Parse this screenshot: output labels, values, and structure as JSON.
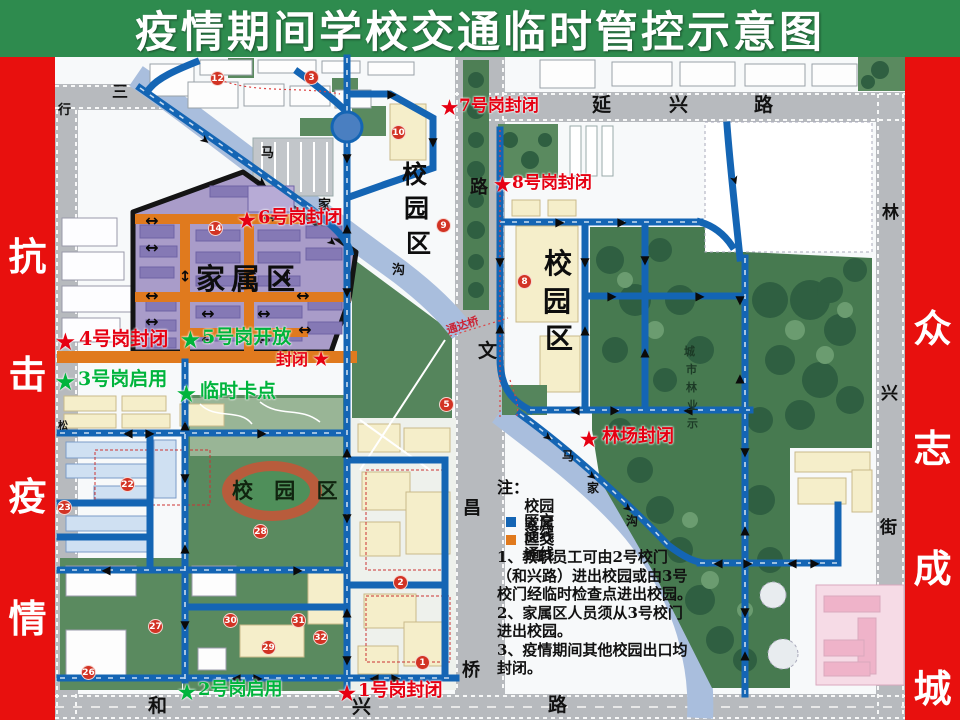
{
  "title": "疫情期间学校交通临时管控示意图",
  "banners": {
    "left": [
      "抗",
      "击",
      "疫",
      "情"
    ],
    "right": [
      "众",
      "志",
      "成",
      "城"
    ]
  },
  "colors": {
    "green_bg": "#2e8b4e",
    "red_banner": "#e8100e",
    "map_bg": "#f7f9fa",
    "road": "#b7babe",
    "river": "#a9bedd",
    "route_blue": "#1465b4",
    "family_orange": "#e07a1e",
    "family_purple": "#a99cc9",
    "forest": "#477a50",
    "lawn": "#5a8a5f",
    "building_cream": "#f5eeca",
    "building_blue": "#cfe0f2",
    "pink": "#f6dbe6",
    "track": "#b85c3c",
    "label_red": "#e60012",
    "label_green": "#00b43c"
  },
  "gates": {
    "gate7": {
      "star": "★",
      "text": "7号岗封闭"
    },
    "gate8": {
      "star": "★",
      "text": "8号岗封闭"
    },
    "gate6": {
      "star": "★",
      "text": "6号岗封闭"
    },
    "gate4": {
      "star": "★",
      "text": "4号岗封闭"
    },
    "gate5": {
      "star": "★",
      "text": "5号岗开放"
    },
    "fengbi": {
      "star": "★",
      "text": "封闭"
    },
    "gate3": {
      "star": "★",
      "text": "3号岗启用"
    },
    "checkpoint": {
      "star": "★",
      "text": "临时卡点"
    },
    "linchang": {
      "star": "★",
      "text": "林场封闭"
    },
    "gate2": {
      "star": "★",
      "text": "2号岗启用"
    },
    "gate1": {
      "star": "★",
      "text": "1号岗封闭"
    }
  },
  "zones": {
    "family": "家属区",
    "campus_left_v": [
      "校",
      "园",
      "区"
    ],
    "campus_right_v": [
      "校",
      "园",
      "区"
    ],
    "campus_stadium": "校 园 区",
    "forest_label": [
      "城",
      "市",
      "林",
      "业",
      "示"
    ]
  },
  "streets": {
    "yanxing": [
      "延",
      "兴",
      "路"
    ],
    "hexing": [
      "和",
      "兴",
      "路"
    ],
    "linxing": [
      "林",
      "兴",
      "街"
    ],
    "wenchang": [
      "路",
      "文",
      "昌",
      "桥"
    ],
    "sanxing": [
      "三",
      "行"
    ],
    "song": "松",
    "river_left": [
      "马",
      "家",
      "沟"
    ],
    "river_right": [
      "马",
      "家",
      "沟"
    ],
    "tongdaqiao": "通达桥"
  },
  "legend": {
    "heading": "注：",
    "items": [
      {
        "label": "校园区交通线",
        "color": "#1465b4"
      },
      {
        "label": "家属区交通线",
        "color": "#e07a1e"
      }
    ],
    "notes": [
      "1、教职员工可由2号校门",
      "（和兴路）进出校园或由3号",
      "校门经临时检查点进出校园。",
      "2、家属区人员须从3号校门",
      "进出校园。",
      "3、疫情期间其他校园出口均",
      "封闭。"
    ]
  },
  "badges": [
    {
      "n": "12",
      "x": 217,
      "y": 78
    },
    {
      "n": "3",
      "x": 311,
      "y": 77
    },
    {
      "n": "10",
      "x": 398,
      "y": 132
    },
    {
      "n": "9",
      "x": 443,
      "y": 225
    },
    {
      "n": "14",
      "x": 215,
      "y": 228
    },
    {
      "n": "8",
      "x": 524,
      "y": 281
    },
    {
      "n": "5",
      "x": 446,
      "y": 404
    },
    {
      "n": "22",
      "x": 127,
      "y": 484
    },
    {
      "n": "23",
      "x": 64,
      "y": 507
    },
    {
      "n": "28",
      "x": 260,
      "y": 531
    },
    {
      "n": "27",
      "x": 155,
      "y": 626
    },
    {
      "n": "30",
      "x": 230,
      "y": 620
    },
    {
      "n": "31",
      "x": 298,
      "y": 620
    },
    {
      "n": "29",
      "x": 268,
      "y": 647
    },
    {
      "n": "26",
      "x": 88,
      "y": 672
    },
    {
      "n": "32",
      "x": 320,
      "y": 637
    },
    {
      "n": "1",
      "x": 422,
      "y": 662
    },
    {
      "n": "2",
      "x": 400,
      "y": 582
    }
  ],
  "arrows": [
    {
      "x": 347,
      "y": 158,
      "g": "▼"
    },
    {
      "x": 347,
      "y": 228,
      "g": "▲"
    },
    {
      "x": 347,
      "y": 292,
      "g": "▼"
    },
    {
      "x": 347,
      "y": 452,
      "g": "▲"
    },
    {
      "x": 347,
      "y": 518,
      "g": "▼"
    },
    {
      "x": 347,
      "y": 612,
      "g": "▲"
    },
    {
      "x": 347,
      "y": 660,
      "g": "▼"
    },
    {
      "x": 205,
      "y": 140,
      "g": "➤",
      "r": 38
    },
    {
      "x": 262,
      "y": 182,
      "g": "➤",
      "r": 38
    },
    {
      "x": 314,
      "y": 221,
      "g": "➤",
      "r": 38
    },
    {
      "x": 185,
      "y": 425,
      "g": "▲"
    },
    {
      "x": 185,
      "y": 478,
      "g": "▼"
    },
    {
      "x": 185,
      "y": 548,
      "g": "▲"
    },
    {
      "x": 185,
      "y": 625,
      "g": "▼"
    },
    {
      "x": 236,
      "y": 678,
      "g": "◀"
    },
    {
      "x": 258,
      "y": 678,
      "g": "▶"
    },
    {
      "x": 374,
      "y": 678,
      "g": "◀"
    },
    {
      "x": 396,
      "y": 678,
      "g": "▶"
    },
    {
      "x": 128,
      "y": 433,
      "g": "◀"
    },
    {
      "x": 150,
      "y": 433,
      "g": "▶"
    },
    {
      "x": 262,
      "y": 433,
      "g": "▶"
    },
    {
      "x": 106,
      "y": 570,
      "g": "◀"
    },
    {
      "x": 298,
      "y": 570,
      "g": "▶"
    },
    {
      "x": 433,
      "y": 142,
      "g": "▼"
    },
    {
      "x": 392,
      "y": 94,
      "g": "▶"
    },
    {
      "x": 560,
      "y": 222,
      "g": "▶"
    },
    {
      "x": 622,
      "y": 222,
      "g": "▶"
    },
    {
      "x": 500,
      "y": 262,
      "g": "▼"
    },
    {
      "x": 500,
      "y": 328,
      "g": "▲"
    },
    {
      "x": 585,
      "y": 262,
      "g": "▼"
    },
    {
      "x": 585,
      "y": 330,
      "g": "▲"
    },
    {
      "x": 645,
      "y": 260,
      "g": "▼"
    },
    {
      "x": 645,
      "y": 352,
      "g": "▲"
    },
    {
      "x": 612,
      "y": 296,
      "g": "▶"
    },
    {
      "x": 700,
      "y": 296,
      "g": "▶"
    },
    {
      "x": 740,
      "y": 300,
      "g": "▼"
    },
    {
      "x": 740,
      "y": 378,
      "g": "▲"
    },
    {
      "x": 745,
      "y": 452,
      "g": "▼"
    },
    {
      "x": 745,
      "y": 530,
      "g": "▲"
    },
    {
      "x": 745,
      "y": 612,
      "g": "▼"
    },
    {
      "x": 745,
      "y": 655,
      "g": "▲"
    },
    {
      "x": 575,
      "y": 410,
      "g": "◀"
    },
    {
      "x": 615,
      "y": 410,
      "g": "▶"
    },
    {
      "x": 688,
      "y": 410,
      "g": "◀"
    },
    {
      "x": 548,
      "y": 437,
      "g": "➤",
      "r": 38
    },
    {
      "x": 592,
      "y": 476,
      "g": "➤",
      "r": 38
    },
    {
      "x": 628,
      "y": 508,
      "g": "➤",
      "r": 38
    },
    {
      "x": 718,
      "y": 563,
      "g": "◀"
    },
    {
      "x": 748,
      "y": 563,
      "g": "▶"
    },
    {
      "x": 792,
      "y": 563,
      "g": "◀"
    },
    {
      "x": 815,
      "y": 563,
      "g": "▶"
    },
    {
      "x": 735,
      "y": 180,
      "g": "➤",
      "r": 72
    },
    {
      "x": 332,
      "y": 242,
      "g": "➤",
      "r": 38
    },
    {
      "x": 152,
      "y": 221,
      "g": "↔",
      "s": 16
    },
    {
      "x": 152,
      "y": 248,
      "g": "↔",
      "s": 16
    },
    {
      "x": 152,
      "y": 296,
      "g": "↔",
      "s": 16
    },
    {
      "x": 152,
      "y": 322,
      "g": "↔",
      "s": 16
    },
    {
      "x": 208,
      "y": 314,
      "g": "↔",
      "s": 16
    },
    {
      "x": 264,
      "y": 314,
      "g": "↔",
      "s": 16
    },
    {
      "x": 208,
      "y": 340,
      "g": "↔",
      "s": 16
    },
    {
      "x": 264,
      "y": 340,
      "g": "↔",
      "s": 16
    },
    {
      "x": 303,
      "y": 296,
      "g": "↔",
      "s": 16
    },
    {
      "x": 305,
      "y": 330,
      "g": "↔",
      "s": 16
    },
    {
      "x": 270,
      "y": 218,
      "g": "↔",
      "s": 16
    },
    {
      "x": 185,
      "y": 277,
      "g": "↕",
      "s": 15
    },
    {
      "x": 287,
      "y": 277,
      "g": "↕",
      "s": 15
    }
  ]
}
